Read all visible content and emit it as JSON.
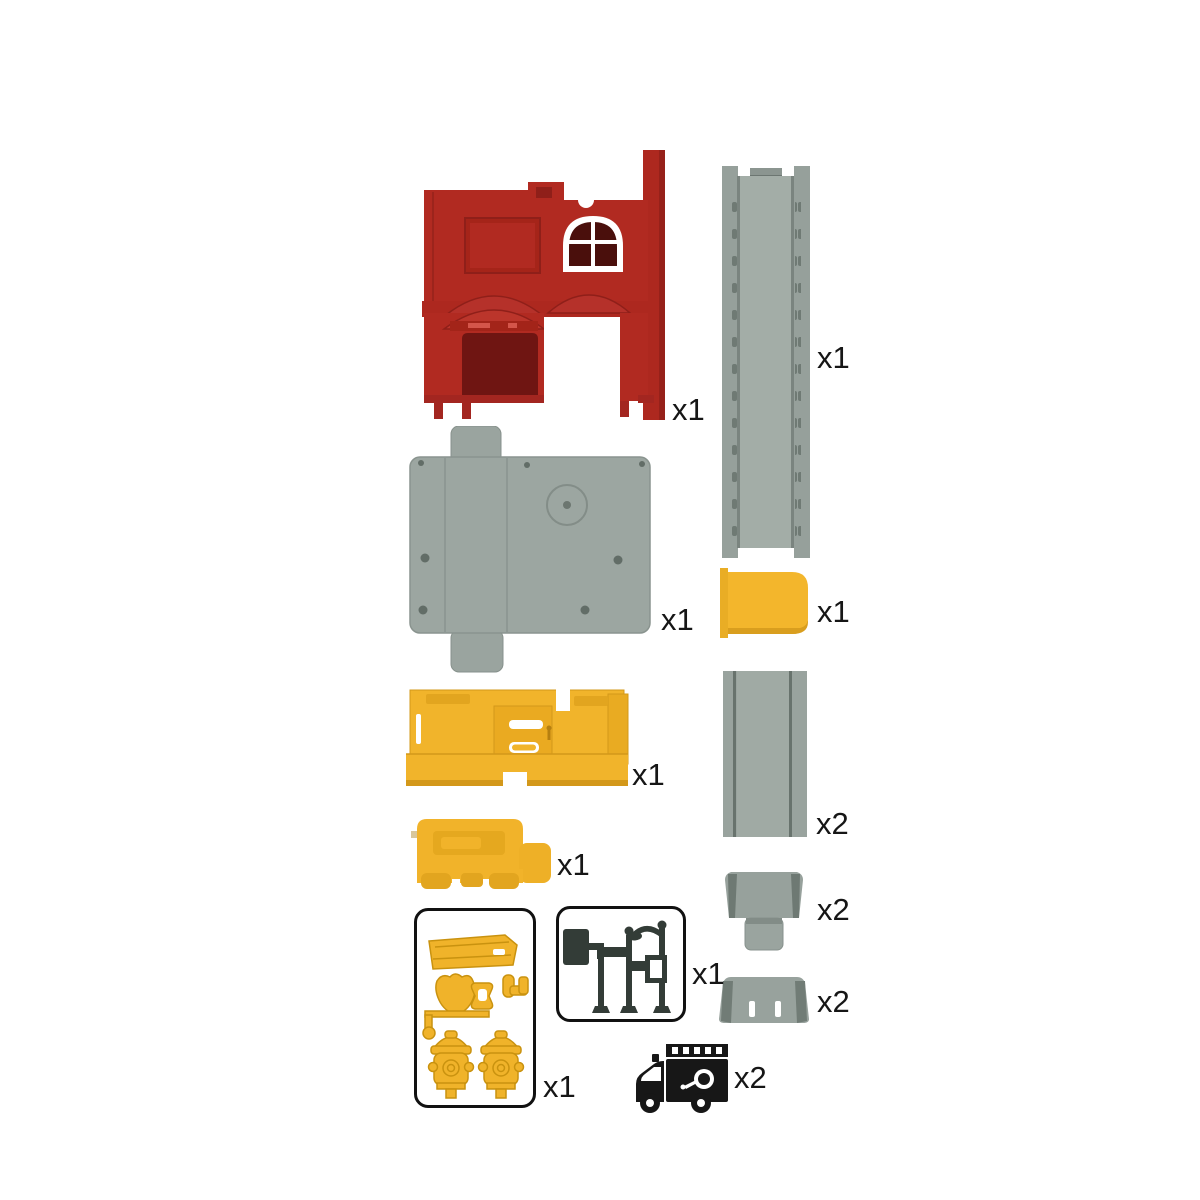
{
  "sheet": {
    "background": "#ffffff"
  },
  "colors": {
    "red": "#b12a21",
    "red_dark": "#8f1f19",
    "door_red": "#6f1512",
    "gray": "#98a29d",
    "gray_dark": "#6e7973",
    "yellow": "#f1b42b",
    "yellow_dark": "#d3981a",
    "ink": "#171717"
  },
  "parts": {
    "red_facade": {
      "icon": "fire-station-facade",
      "qty": "x1"
    },
    "long_track": {
      "icon": "long-straight-track",
      "qty": "x1"
    },
    "base_plate": {
      "icon": "base-plate",
      "qty": "x1"
    },
    "yellow_panel": {
      "icon": "door-panel",
      "qty": "x1"
    },
    "yellow_wall": {
      "icon": "wall-panel",
      "qty": "x1"
    },
    "short_track": {
      "icon": "short-straight-track",
      "qty": "x2"
    },
    "vehicle_base": {
      "icon": "vehicle-base",
      "qty": "x1"
    },
    "ramp_with_tab": {
      "icon": "ramp-with-tab",
      "qty": "x2"
    },
    "ramp": {
      "icon": "ramp",
      "qty": "x2"
    },
    "accessory_sprue": {
      "icon": "hydrant-accessory-sprue",
      "qty": "x1"
    },
    "sign_sprue": {
      "icon": "street-sign-sprue",
      "qty": "x1"
    },
    "fire_truck": {
      "icon": "fire-truck",
      "qty": "x2"
    }
  }
}
